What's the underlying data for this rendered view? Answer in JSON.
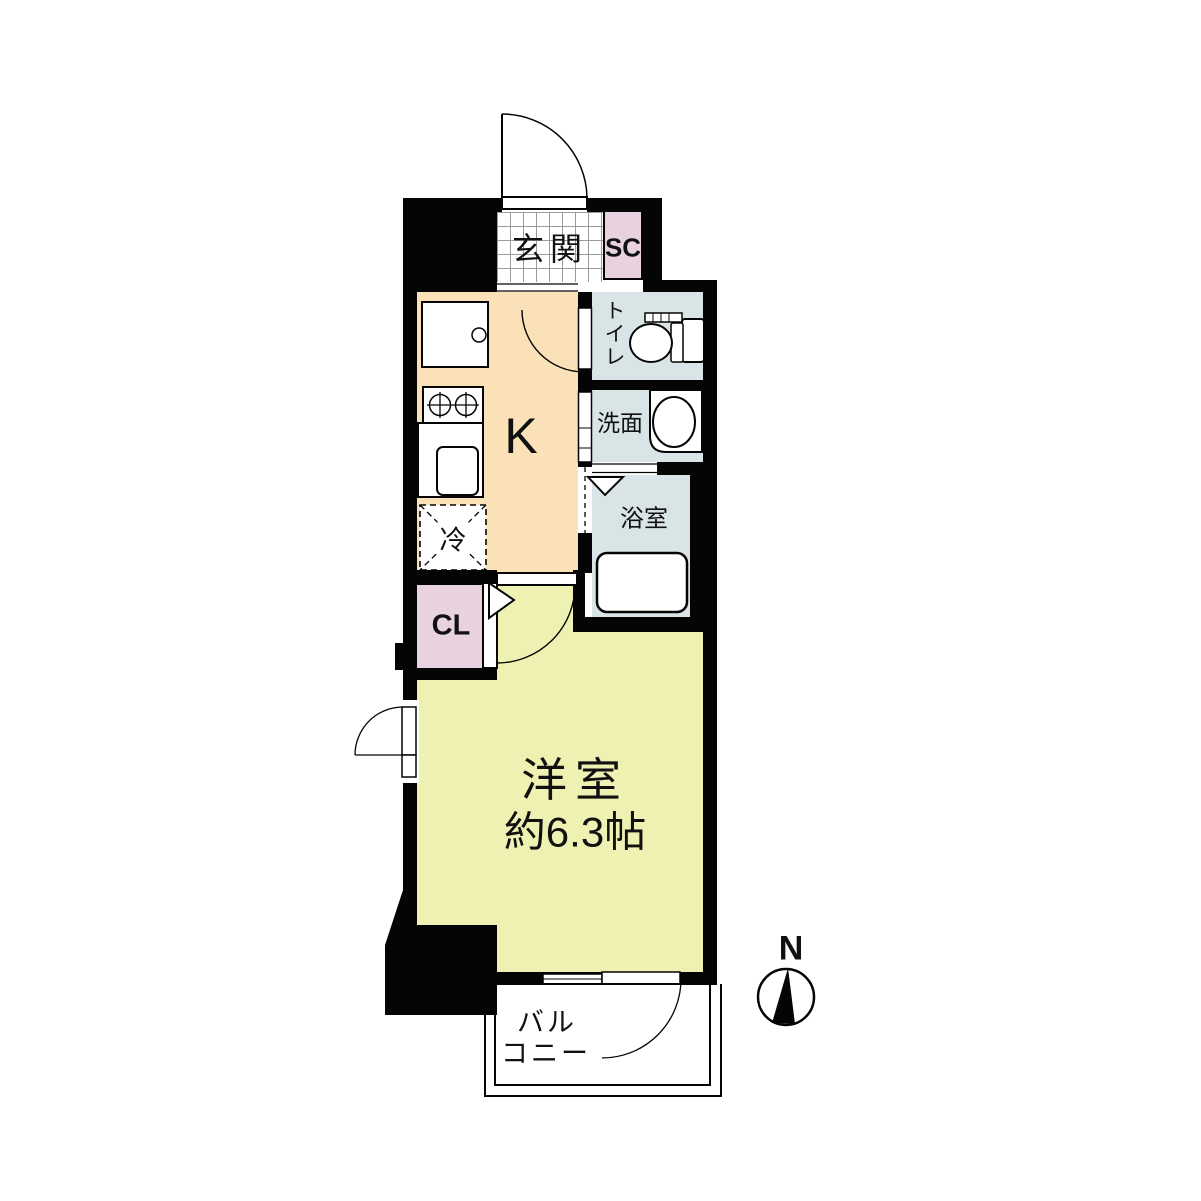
{
  "floorplan": {
    "rooms": {
      "entrance": {
        "label": "玄関"
      },
      "shoe_closet": {
        "label": "SC"
      },
      "toilet": {
        "label": "トイレ"
      },
      "washroom": {
        "label": "洗面"
      },
      "bathroom": {
        "label": "浴室"
      },
      "kitchen": {
        "label": "K"
      },
      "refrigerator": {
        "label": "冷"
      },
      "closet": {
        "label": "CL"
      },
      "western_room": {
        "label": "洋室",
        "size": "約6.3帖"
      },
      "balcony": {
        "line1": "バル",
        "line2": "コニー"
      }
    },
    "compass": {
      "north": "N"
    },
    "colors": {
      "wall": "#050505",
      "shoe_closet_fill": "#e9d2df",
      "closet_fill": "#e9d2df",
      "wet_area_fill": "#d8e4e5",
      "kitchen_fill": "#fae1b7",
      "western_room_fill": "#eff1b2",
      "entrance_tile": "#ffffff",
      "background": "#ffffff"
    }
  }
}
